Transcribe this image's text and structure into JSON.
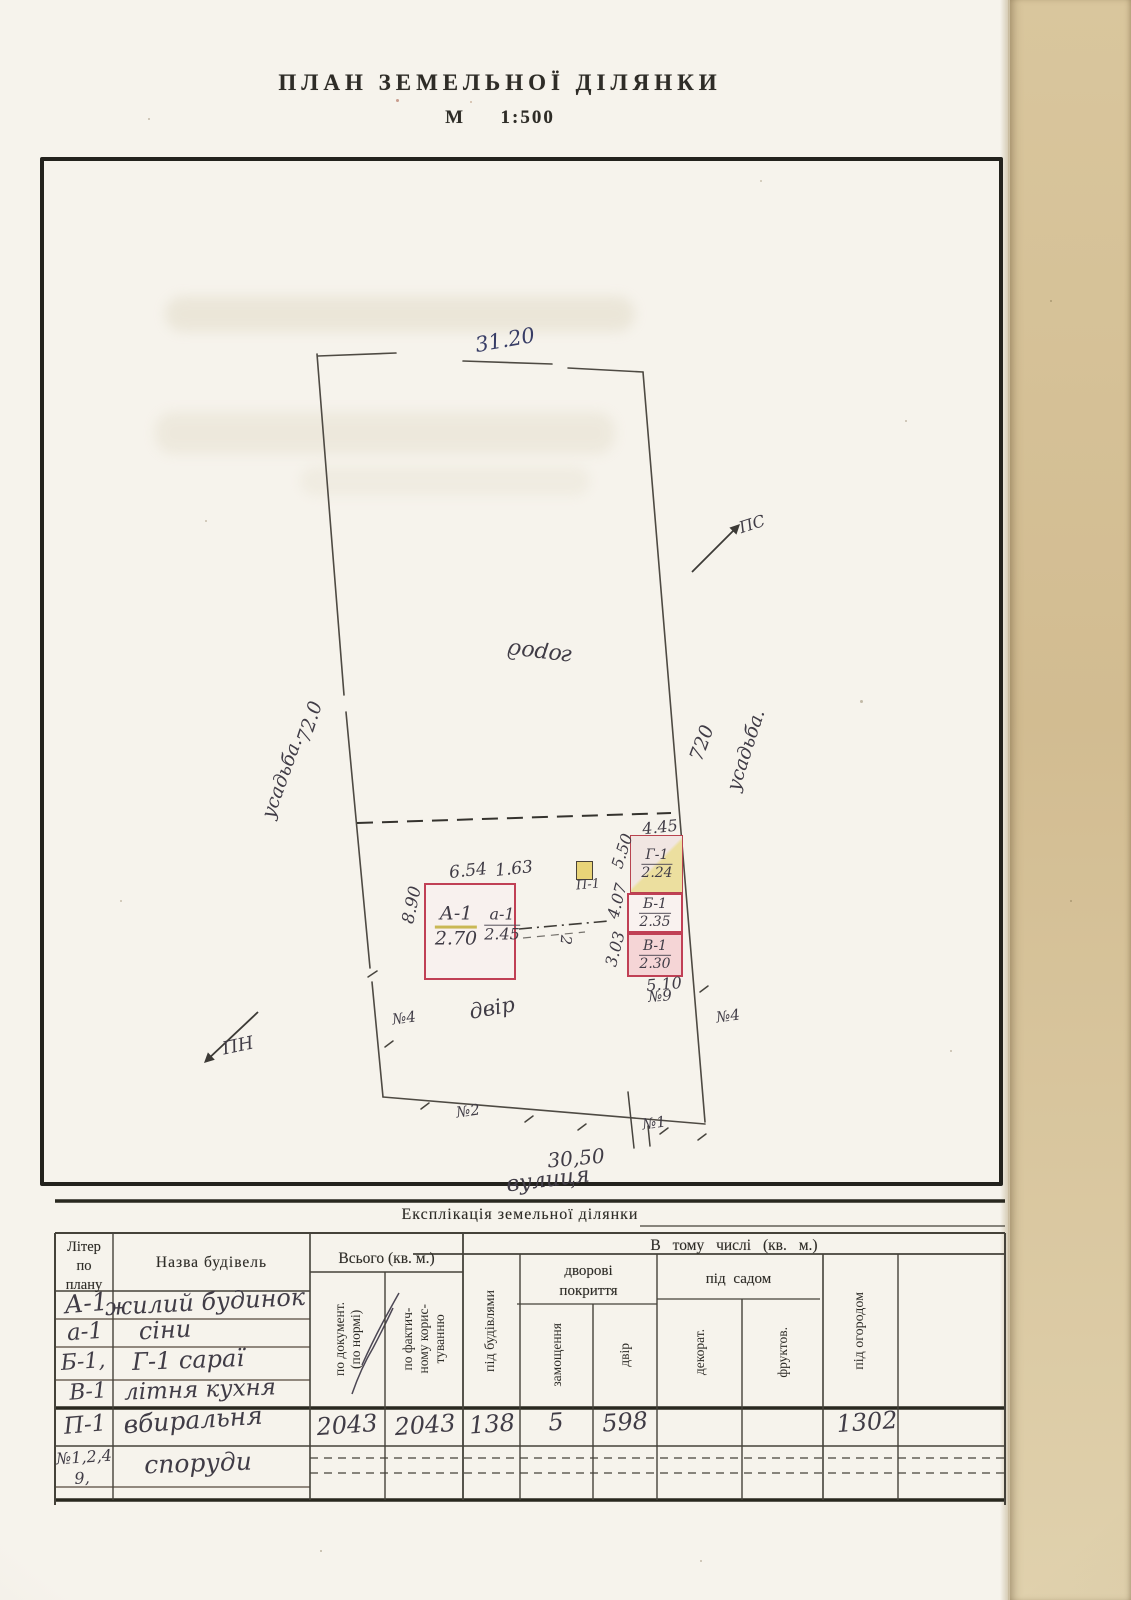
{
  "page": {
    "title": "ПЛАН ЗЕМЕЛЬНОЇ ДІЛЯНКИ",
    "scale_prefix": "М",
    "scale_value": "1:500"
  },
  "plan": {
    "dim_top": "31.20",
    "dim_bottom": "30,50",
    "dim_left": "72.0",
    "dim_right": "720",
    "neighbor_left": "усадьба.",
    "neighbor_right": "усадьба.",
    "area_garden": "город",
    "area_yard": "двір",
    "street_name": "вулиця",
    "dir_north": "ПН",
    "dir_south": "ПС",
    "marker_n1": "№1",
    "marker_n2": "№2",
    "marker_n4_left": "№4",
    "marker_n4_right": "№4",
    "marker_n9": "№9",
    "fence_mark": "2",
    "house": {
      "id_main": "А-1",
      "area_main": "2.70",
      "id_annex": "а-1",
      "area_annex": "2.45",
      "dim_width_main": "6.54",
      "dim_width_annex": "1.63",
      "dim_height": "8.90"
    },
    "bld_g": {
      "id": "Г-1",
      "area": "2.24",
      "dim_width": "4.45",
      "dim_height": "5.50"
    },
    "bld_b": {
      "id": "Б-1",
      "area": "2.35",
      "dim_height": "4.07"
    },
    "bld_v": {
      "id": "В-1",
      "area": "2.30",
      "dim_height": "3.03",
      "dim_width": "5.10"
    },
    "bld_p": {
      "id": "П-1"
    }
  },
  "table": {
    "caption": "Експлікація земельної ділянки",
    "col_liter": "Літер\nпо\nплану",
    "col_name": "Назва будівель",
    "col_total": "Всього  (кв. м.)",
    "col_total_doc": "по документ.\n(по нормі)",
    "col_total_fact": "по фактич-\nному корис-\nтуванню",
    "col_included": "В  тому  числі   (кв. м.)",
    "col_buildings": "під будівлями",
    "group_yard_cover": "дворові\nпокриття",
    "col_paving": "замощення",
    "col_yard": "двір",
    "group_garden": "під  садом",
    "col_decorative": "декорат.",
    "col_fruit": "фруктов.",
    "col_vegetable": "під огородом",
    "rows": [
      {
        "liter": "А-1",
        "name": "жилий будинок"
      },
      {
        "liter": "а-1",
        "name": "сіни"
      },
      {
        "liter": "Б-1,",
        "name": "Г-1  сараї"
      },
      {
        "liter": "В-1",
        "name": "літня кухня"
      },
      {
        "liter": "П-1",
        "name": "вбиральня",
        "total_doc": "2043",
        "total_fact": "2043",
        "buildings": "138",
        "paving": "5",
        "yard": "598",
        "vegetable": "1302"
      },
      {
        "liter": "№1,2,4",
        "liter2": "9,",
        "name": "споруди"
      }
    ]
  }
}
